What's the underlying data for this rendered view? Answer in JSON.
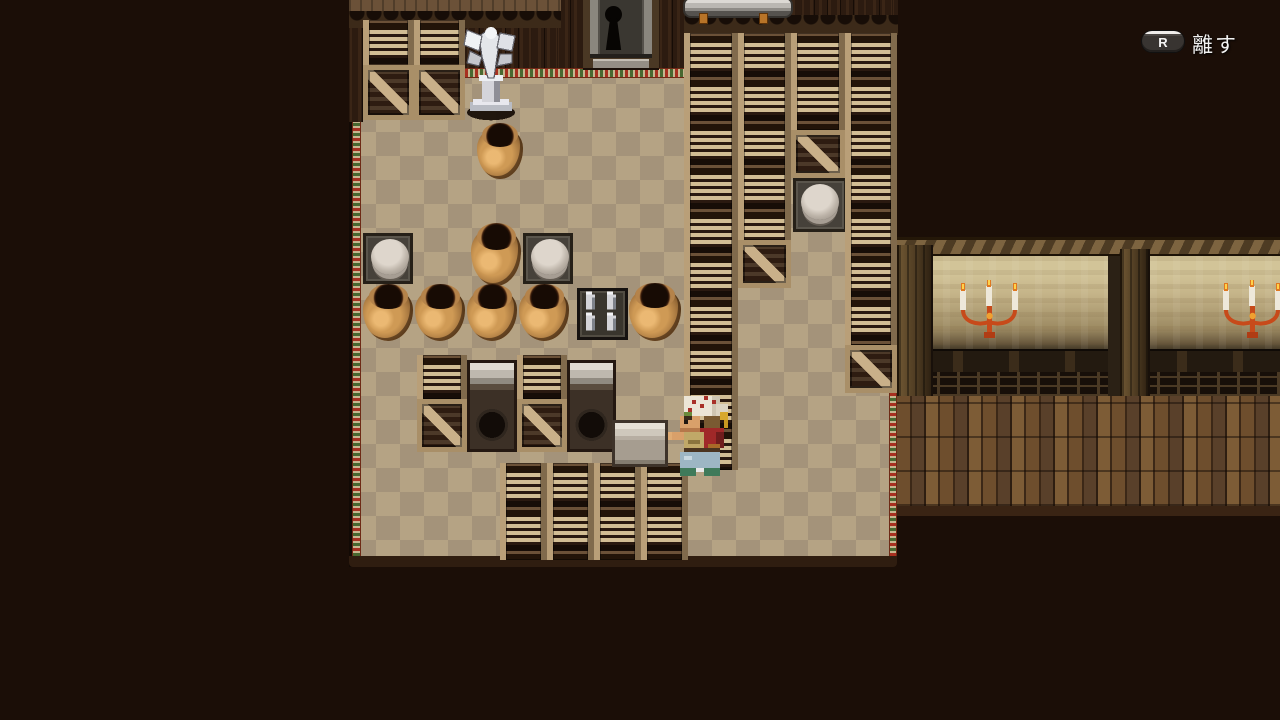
{
  "hud": {
    "key_hint": {
      "button": "R",
      "label": "離す"
    }
  },
  "scene": {
    "description": "pixel-art RPG storage room with checkered floor, crates, clay pots, barrels and a hallway with candle sconces",
    "hero": {
      "action": "carrying-crate",
      "facing": "left"
    },
    "objects": [
      "silver-statue",
      "clay-pot",
      "barrel",
      "wooden-crate",
      "metal-furnace",
      "silver-jugs",
      "keyhole-door",
      "carried-crate",
      "hero-character",
      "candelabra",
      "metal-basin"
    ]
  },
  "colors": {
    "background": "#1b0e07",
    "floor_light": "#b5a384",
    "floor_dark": "#a4937a",
    "carpet_trim_red": "#a83020",
    "carpet_trim_green": "#486830",
    "crate_wood": "#c9b089",
    "pot_clay": "#b5854a",
    "corridor_wall": "#c4b388",
    "candle_flame": "#f0a830",
    "hud_text": "#f2f2f2"
  }
}
